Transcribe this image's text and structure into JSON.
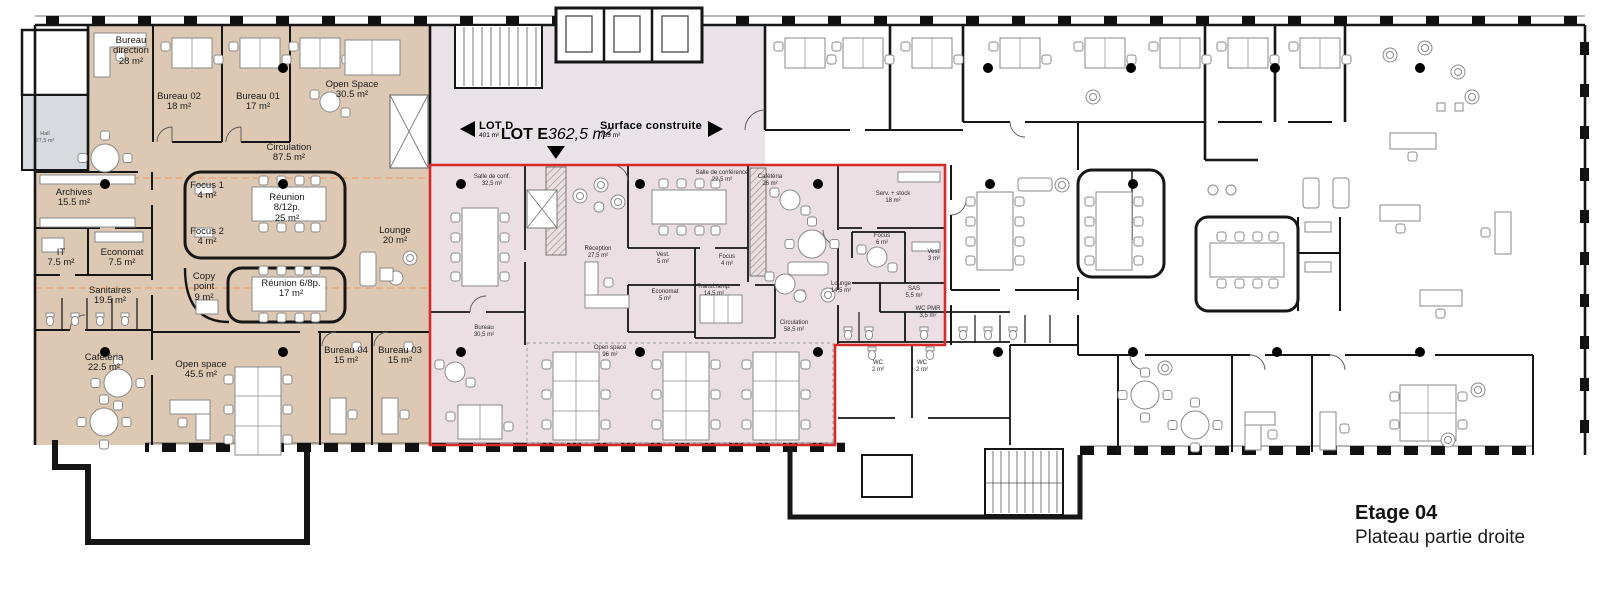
{
  "title": {
    "name": "Etage 04",
    "subtitle": "Plateau partie droite"
  },
  "markers": {
    "lot_d": {
      "label": "LOT D",
      "area": "401 m²"
    },
    "lot_e": {
      "label": "LOT E",
      "area": "362,5 m²"
    },
    "surface": {
      "label": "Surface construite",
      "area": "733 m²"
    }
  },
  "left_zone": {
    "rooms": [
      {
        "name": "Bureau direction",
        "area": "28 m²"
      },
      {
        "name": "Bureau 02",
        "area": "18 m²"
      },
      {
        "name": "Bureau 01",
        "area": "17 m²"
      },
      {
        "name": "Open Space",
        "area": "30.5 m²"
      },
      {
        "name": "Circulation",
        "area": "87.5 m²"
      },
      {
        "name": "Archives",
        "area": "15.5 m²"
      },
      {
        "name": "Focus 1",
        "area": "4 m²"
      },
      {
        "name": "Réunion 8/12p.",
        "area": "25 m²"
      },
      {
        "name": "Focus 2",
        "area": "4 m²"
      },
      {
        "name": "Lounge",
        "area": "20 m²"
      },
      {
        "name": "IT",
        "area": "7.5 m²"
      },
      {
        "name": "Economat",
        "area": "7.5 m²"
      },
      {
        "name": "Copy point",
        "area": "9 m²"
      },
      {
        "name": "Réunion 6/8p.",
        "area": "17 m²"
      },
      {
        "name": "Sanitaires",
        "area": "19.5 m²"
      },
      {
        "name": "Cafétéria",
        "area": "22.5 m²"
      },
      {
        "name": "Open space",
        "area": "45.5 m²"
      },
      {
        "name": "Bureau 04",
        "area": "15 m²"
      },
      {
        "name": "Bureau 03",
        "area": "15 m²"
      },
      {
        "name": "Hall",
        "area": "27,5 m²"
      }
    ]
  },
  "lot_e_zone": {
    "rooms": [
      {
        "name": "Salle de conf.",
        "area": "32,5 m²"
      },
      {
        "name": "Salle de conférence",
        "area": "22,5 m²"
      },
      {
        "name": "Cafétéria",
        "area": "26 m²"
      },
      {
        "name": "Serv. + stock",
        "area": "18 m²"
      },
      {
        "name": "Réception",
        "area": "27,5 m²"
      },
      {
        "name": "Vest.",
        "area": "5 m²"
      },
      {
        "name": "Focus",
        "area": "4 m²"
      },
      {
        "name": "Economat",
        "area": "5 m²"
      },
      {
        "name": "Transf./amp.",
        "area": "14,5 m²"
      },
      {
        "name": "Lounge",
        "area": "14,5 m²"
      },
      {
        "name": "Focus",
        "area": "6 m²"
      },
      {
        "name": "Vest.",
        "area": "3 m²"
      },
      {
        "name": "SAS",
        "area": "5,5 m²"
      },
      {
        "name": "WC PMR",
        "area": "3,5 m²"
      },
      {
        "name": "Circulation",
        "area": "58,5 m²"
      },
      {
        "name": "Bureau",
        "area": "30,5 m²"
      },
      {
        "name": "Open space",
        "area": "96 m²"
      }
    ]
  },
  "annex": {
    "rooms": [
      {
        "name": "WC",
        "area": "2 m²"
      },
      {
        "name": "WC",
        "area": "2 m²"
      }
    ]
  },
  "colors": {
    "beige_zone": "#dcc8b3",
    "pink_strip": "#e9e2e7",
    "lot_e_fill": "#ecdfe4",
    "lot_e_border": "#d62b28",
    "gray_room": "#d7dbdf",
    "wall": "#161616",
    "orange_guide": "#eba36e"
  }
}
